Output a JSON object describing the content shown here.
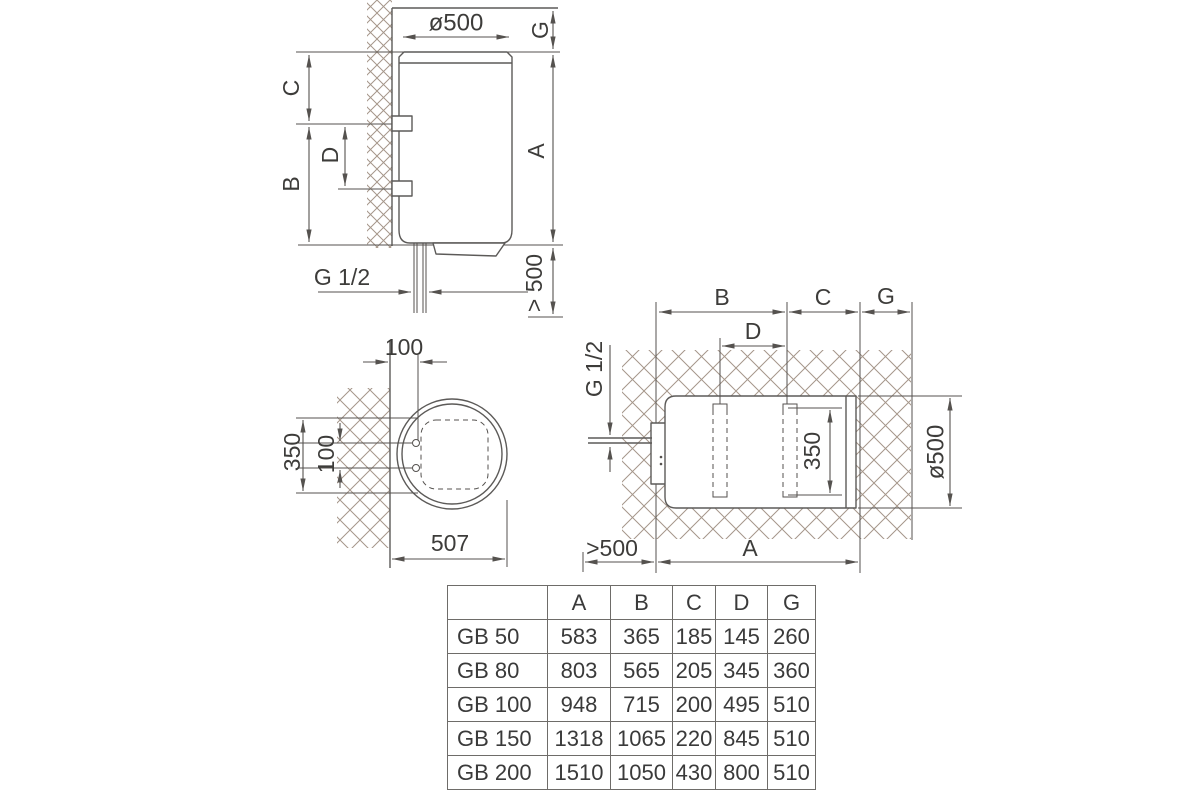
{
  "d1": {
    "dia": "ø500",
    "g": "G",
    "a": "A",
    "c": "C",
    "d": "D",
    "b": "B",
    "thread": "G 1/2",
    "clearance": "> 500"
  },
  "d2": {
    "offset": "100",
    "span": "350",
    "holes": "100",
    "depth": "507"
  },
  "d3": {
    "b": "B",
    "c": "C",
    "g": "G",
    "d": "D",
    "thread": "G 1/2",
    "span": "350",
    "dia": "ø500",
    "clearance": ">500",
    "a": "A"
  },
  "table": {
    "columns": [
      "",
      "A",
      "B",
      "C",
      "D",
      "G"
    ],
    "rows": [
      {
        "model": "GB 50",
        "A": "583",
        "B": "365",
        "C": "185",
        "D": "145",
        "G": "260"
      },
      {
        "model": "GB 80",
        "A": "803",
        "B": "565",
        "C": "205",
        "D": "345",
        "G": "360"
      },
      {
        "model": "GB 100",
        "A": "948",
        "B": "715",
        "C": "200",
        "D": "495",
        "G": "510"
      },
      {
        "model": "GB 150",
        "A": "1318",
        "B": "1065",
        "C": "220",
        "D": "845",
        "G": "510"
      },
      {
        "model": "GB 200",
        "A": "1510",
        "B": "1050",
        "C": "430",
        "D": "800",
        "G": "510"
      }
    ]
  },
  "colors": {
    "line": "#5c5a58",
    "dim": "#55524f",
    "text": "#3d3c3a",
    "hatch": "#a5968a",
    "table_border": "#6e6c69"
  }
}
